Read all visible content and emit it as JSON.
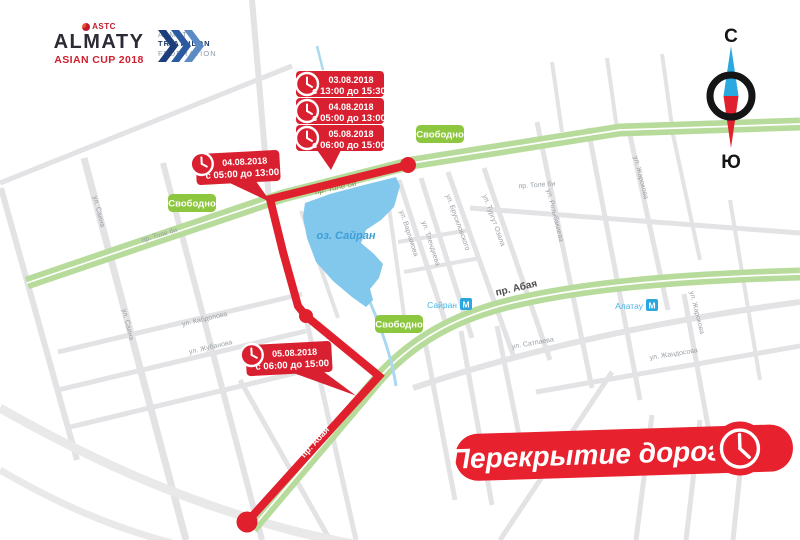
{
  "header": {
    "astc": {
      "mark": "ASTC",
      "title": "ALMATY",
      "subtitle": "ASIAN CUP 2018"
    },
    "federation": {
      "line1": "ALMATY",
      "line2": "TRIATHLON",
      "line3": "FEDERATION"
    }
  },
  "compass": {
    "north": "С",
    "south": "Ю"
  },
  "banner": {
    "label": "Перекрытие дорог"
  },
  "badges": [
    "Свободно",
    "Свободно",
    "Свободно"
  ],
  "callouts": {
    "stack": [
      {
        "date": "03.08.2018",
        "time": "с 13:00 до 15:30"
      },
      {
        "date": "04.08.2018",
        "time": "с 05:00 до 13:00"
      },
      {
        "date": "05.08.2018",
        "time": "с 06:00 до 15:00"
      }
    ],
    "west": {
      "date": "04.08.2018",
      "time": "с 05:00 до 13:00"
    },
    "south": {
      "date": "05.08.2018",
      "time": "с 06:00 до 15:00"
    }
  },
  "map": {
    "lake": "оз. Сайран",
    "metro": [
      {
        "name": "Сайран",
        "symbol": "М"
      },
      {
        "name": "Алатау",
        "symbol": "М"
      }
    ],
    "streets": {
      "tolebi1": "пр. Толе би",
      "tolebi2": "пр. Толе би",
      "tolebi3": "пр. Толе би",
      "saina1": "ул. Саина",
      "saina2": "ул. Саина",
      "varlamova": "ул. Варламова",
      "tlendieva": "ул. Тлендиева",
      "brusilovskogo": "ул. Брусиловского",
      "turgut": "ул. Тургут Озала",
      "rozybakieva": "ул. Розыбакиева",
      "zharokova1": "ул. Жарокова",
      "zharokova2": "ул. Жарокова",
      "satpaeva": "ул. Сатпаева",
      "zhandosova": "ул. Жандосова",
      "kabdolova": "ул. Кабдолова",
      "zhubanova": "ул. Жубанова",
      "abaya": "пр. Абая",
      "utegen_closed": "ул. Утеген батыра",
      "abaya_closed": "пр. Абая"
    }
  },
  "colors": {
    "closure_red": "#e0202d",
    "road_green": "#b7db9b",
    "badge_green": "#8dc63f",
    "lake_blue": "#82c7ec",
    "metro_blue": "#2ba7e0"
  }
}
